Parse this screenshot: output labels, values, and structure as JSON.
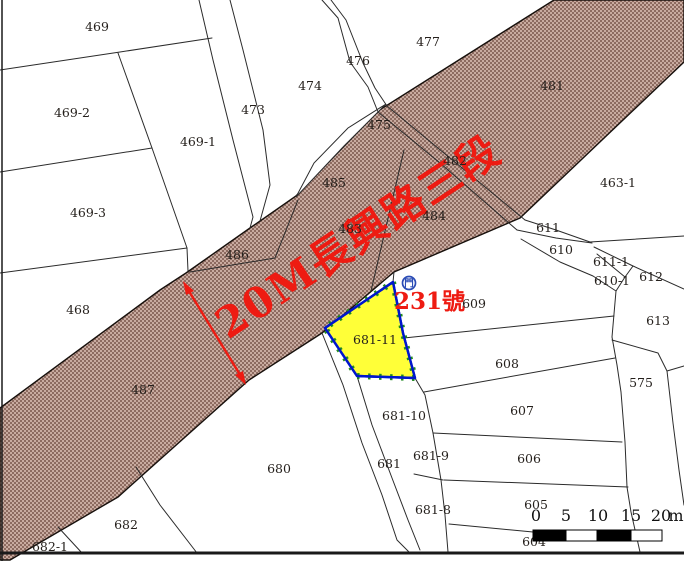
{
  "map": {
    "road_label": "20M長興路三段",
    "address": {
      "icon_glyph": "門",
      "text": "231號"
    },
    "highlight_parcel": "681-11",
    "scale_bar": {
      "ticks": [
        "0",
        "5",
        "10",
        "15",
        "20"
      ],
      "unit": "m"
    },
    "colors": {
      "road_fill_dark": "#8d6b60",
      "road_fill_light": "#c9aba0",
      "highlight_yellow": "#ffff38",
      "highlight_border_blue": "#0016cc",
      "tick_green": "#1f8a1f",
      "annotation_red": "#ee1b12",
      "icon_blue": "#2a4bb5"
    },
    "parcel_labels": [
      {
        "t": "469",
        "x": 97,
        "y": 27
      },
      {
        "t": "469-2",
        "x": 72,
        "y": 113
      },
      {
        "t": "469-3",
        "x": 88,
        "y": 213
      },
      {
        "t": "469-1",
        "x": 198,
        "y": 142
      },
      {
        "t": "473",
        "x": 253,
        "y": 110
      },
      {
        "t": "474",
        "x": 310,
        "y": 86
      },
      {
        "t": "476",
        "x": 358,
        "y": 61
      },
      {
        "t": "477",
        "x": 428,
        "y": 42
      },
      {
        "t": "475",
        "x": 379,
        "y": 125
      },
      {
        "t": "485",
        "x": 334,
        "y": 183
      },
      {
        "t": "486",
        "x": 237,
        "y": 255
      },
      {
        "t": "482",
        "x": 455,
        "y": 161
      },
      {
        "t": "484",
        "x": 434,
        "y": 216
      },
      {
        "t": "483",
        "x": 350,
        "y": 229
      },
      {
        "t": "481",
        "x": 552,
        "y": 86
      },
      {
        "t": "463-1",
        "x": 618,
        "y": 183
      },
      {
        "t": "611",
        "x": 548,
        "y": 228
      },
      {
        "t": "610",
        "x": 561,
        "y": 250
      },
      {
        "t": "611-1",
        "x": 611,
        "y": 262
      },
      {
        "t": "610-1",
        "x": 612,
        "y": 281
      },
      {
        "t": "612",
        "x": 651,
        "y": 277
      },
      {
        "t": "613",
        "x": 658,
        "y": 321
      },
      {
        "t": "609",
        "x": 474,
        "y": 304
      },
      {
        "t": "608",
        "x": 507,
        "y": 364
      },
      {
        "t": "575",
        "x": 641,
        "y": 383
      },
      {
        "t": "607",
        "x": 522,
        "y": 411
      },
      {
        "t": "606",
        "x": 529,
        "y": 459
      },
      {
        "t": "605",
        "x": 536,
        "y": 505
      },
      {
        "t": "604",
        "x": 534,
        "y": 542
      },
      {
        "t": "468",
        "x": 78,
        "y": 310
      },
      {
        "t": "487",
        "x": 143,
        "y": 390
      },
      {
        "t": "680",
        "x": 279,
        "y": 469
      },
      {
        "t": "682",
        "x": 126,
        "y": 525
      },
      {
        "t": "682-1",
        "x": 50,
        "y": 547
      },
      {
        "t": "681-11",
        "x": 375,
        "y": 340
      },
      {
        "t": "681-10",
        "x": 404,
        "y": 416
      },
      {
        "t": "681",
        "x": 389,
        "y": 464
      },
      {
        "t": "681-9",
        "x": 431,
        "y": 456
      },
      {
        "t": "681-8",
        "x": 433,
        "y": 510
      }
    ]
  }
}
